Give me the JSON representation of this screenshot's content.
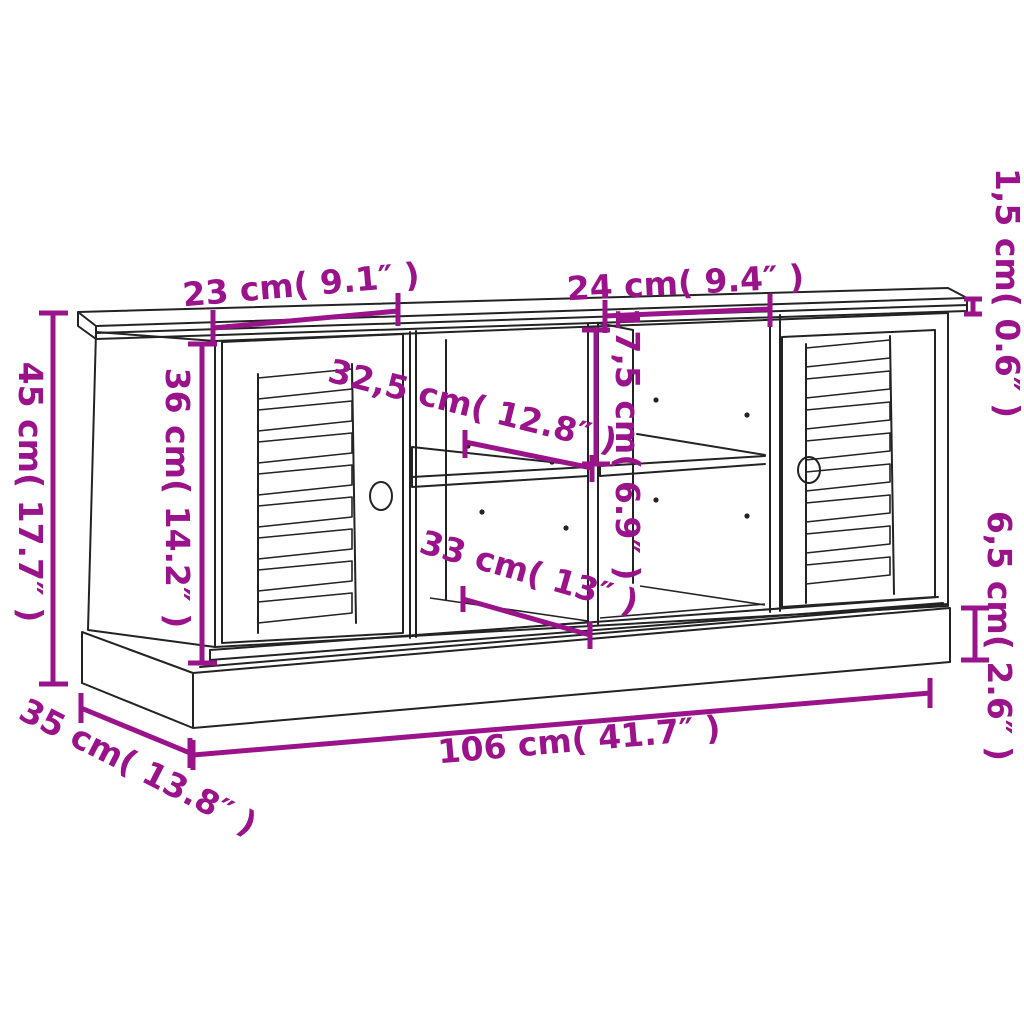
{
  "diagram": {
    "title": "Storage bench with louvered doors — dimension drawing",
    "colors": {
      "dimension_annotation": "#9a138b",
      "furniture_outline": "#232323",
      "background": "#ffffff"
    },
    "dimensions": {
      "left_door_width": "23 cm( 9.1″ )",
      "right_compartment_width": "24 cm( 9.4″ )",
      "top_panel_thickness": "1,5 cm( 0.6″ )",
      "overall_height": "45 cm( 17.7″ )",
      "inner_height": "36 cm( 14.2″ )",
      "shelf_depth": "32,5 cm( 12.8″ )",
      "compartment_height": "17,5 cm( 6.9″ )",
      "lower_compartment_width": "33 cm( 13″ )",
      "plinth_height": "6,5 cm( 2.6″ )",
      "overall_width": "106 cm( 41.7″ )",
      "overall_depth": "35 cm( 13.8″ )"
    }
  }
}
